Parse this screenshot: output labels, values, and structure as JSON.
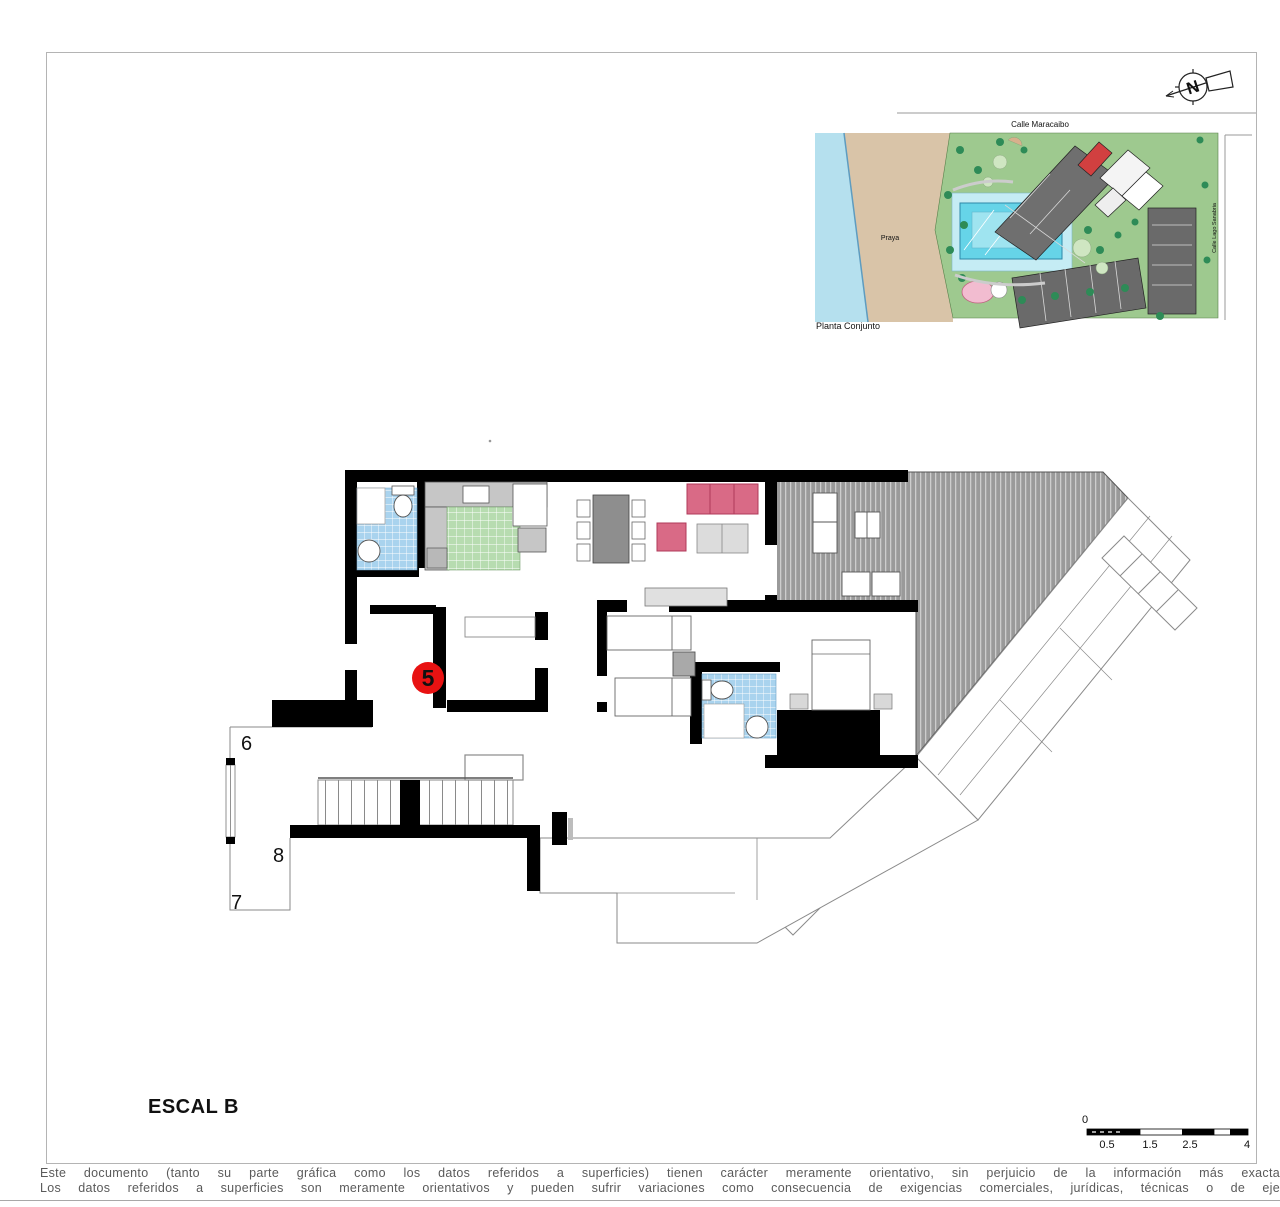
{
  "title": {
    "text": "ESCAL B"
  },
  "north_arrow": {
    "letter": "N"
  },
  "site_plan": {
    "street_top": "Calle Maracaibo",
    "street_right": "Calle Lago Sanabria",
    "beach_label": "Praya",
    "caption": "Planta Conjunto"
  },
  "floor_plan": {
    "unit_marker": "5",
    "landing_numbers": {
      "n6": "6",
      "n8": "8",
      "n7": "7"
    }
  },
  "scale_bar": {
    "zero": "0",
    "ticks": [
      "0.5",
      "1.5",
      "2.5",
      "4"
    ]
  },
  "disclaimer": {
    "line1": "Este documento (tanto su parte gráfica como los datos referidos a superficies) tienen carácter meramente orientativo, sin perjuicio de la información más exacta",
    "line2": "Los datos referidos a superficies son meramente orientativos y pueden sufrir variaciones como consecuencia de exigencias comerciales, jurídicas, técnicas o de eje"
  },
  "colors": {
    "marker_red": "#e81212",
    "sofa_pink": "#d96a86",
    "tile_blue": "#a9d3ee",
    "kitchen_green": "#b7dcb0",
    "terrace_gray": "#9a9a9a",
    "pool_cyan": "#66d4e8",
    "sea_blue": "#b5e0ee",
    "sand_tan": "#d9c4a8",
    "land_green": "#9ec98f",
    "building_gray": "#6a6a6a"
  }
}
